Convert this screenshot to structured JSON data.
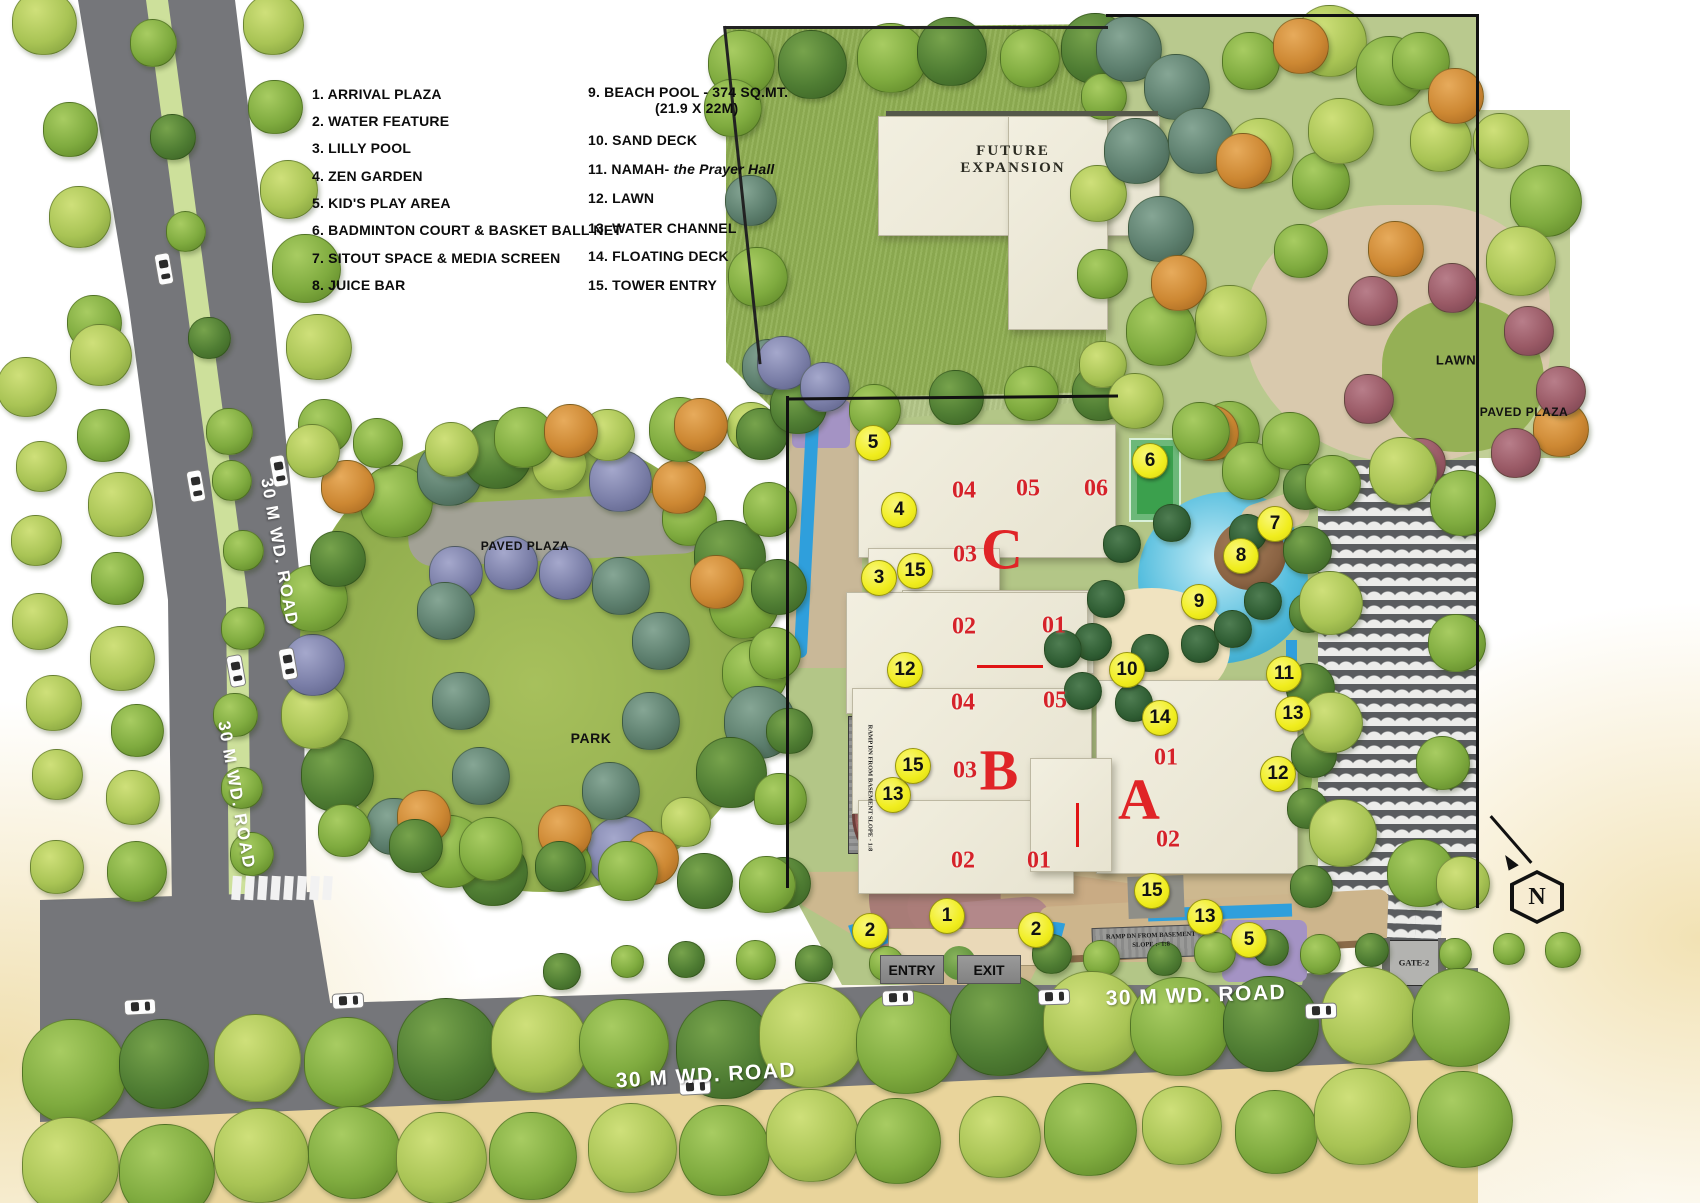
{
  "legend": {
    "left": [
      "1. ARRIVAL PLAZA",
      "2. WATER FEATURE",
      "3. LILLY POOL",
      "4. ZEN GARDEN",
      "5. KID'S PLAY AREA",
      "6. BADMINTON COURT & BASKET BALL NET",
      "7. SITOUT SPACE & MEDIA SCREEN",
      "8. JUICE BAR"
    ],
    "right": [
      {
        "text": "9. BEACH POOL - 374 SQ.MT."
      },
      {
        "text": "(21.9 X 22M)",
        "indent": true
      },
      {
        "text": "10. SAND DECK"
      },
      {
        "text": "11. NAMAH-",
        "italic": " the Prayer Hall"
      },
      {
        "text": "12. LAWN"
      },
      {
        "text": "13. WATER CHANNEL"
      },
      {
        "text": "14. FLOATING DECK"
      },
      {
        "text": "15. TOWER ENTRY"
      }
    ]
  },
  "area_labels": [
    {
      "id": "future-expansion",
      "lines": [
        "FUTURE",
        "EXPANSION"
      ],
      "x": 1013,
      "y": 160,
      "kind": "serif-zone",
      "size": 15
    },
    {
      "id": "lawn-ne",
      "text": "LAWN",
      "x": 1456,
      "y": 360,
      "kind": "zone",
      "size": 13
    },
    {
      "id": "paved-plaza-ne",
      "text": "PAVED PLAZA",
      "x": 1524,
      "y": 412,
      "kind": "zone",
      "size": 12
    },
    {
      "id": "paved-plaza-w",
      "text": "PAVED PLAZA",
      "x": 525,
      "y": 546,
      "kind": "zone",
      "size": 12
    },
    {
      "id": "park",
      "text": "PARK",
      "x": 591,
      "y": 738,
      "kind": "zone",
      "size": 14
    }
  ],
  "gates": {
    "entry_label": "ENTRY",
    "exit_label": "EXIT",
    "gate2_label": "GATE-2",
    "ramp_plaque_lines": [
      "RAMP DN FROM BASEMENT",
      "SLOPE :- 1:8"
    ],
    "ramp_left_text": "RAMP DN FROM BASEMENT   SLOPE - 1:8"
  },
  "road_labels": [
    {
      "text": "30 M WD. ROAD",
      "x": 279,
      "y": 552,
      "rot": 80,
      "size": 17
    },
    {
      "text": "30 M WD. ROAD",
      "x": 236,
      "y": 795,
      "rot": 80,
      "size": 17
    },
    {
      "text": "30 M WD. ROAD",
      "x": 706,
      "y": 1076,
      "rot": -3.5,
      "size": 21
    },
    {
      "text": "30 M WD. ROAD",
      "x": 1196,
      "y": 996,
      "rot": -2,
      "size": 21
    }
  ],
  "markers": [
    {
      "n": "1",
      "x": 947,
      "y": 916
    },
    {
      "n": "2",
      "x": 870,
      "y": 931
    },
    {
      "n": "2",
      "x": 1036,
      "y": 930
    },
    {
      "n": "3",
      "x": 879,
      "y": 578
    },
    {
      "n": "4",
      "x": 899,
      "y": 510
    },
    {
      "n": "5",
      "x": 873,
      "y": 443
    },
    {
      "n": "5",
      "x": 1249,
      "y": 940
    },
    {
      "n": "6",
      "x": 1150,
      "y": 461
    },
    {
      "n": "7",
      "x": 1275,
      "y": 524
    },
    {
      "n": "8",
      "x": 1241,
      "y": 556
    },
    {
      "n": "9",
      "x": 1199,
      "y": 602
    },
    {
      "n": "10",
      "x": 1127,
      "y": 670
    },
    {
      "n": "11",
      "x": 1284,
      "y": 674
    },
    {
      "n": "12",
      "x": 905,
      "y": 670
    },
    {
      "n": "12",
      "x": 1278,
      "y": 774
    },
    {
      "n": "13",
      "x": 1293,
      "y": 714
    },
    {
      "n": "13",
      "x": 893,
      "y": 795
    },
    {
      "n": "13",
      "x": 1205,
      "y": 917
    },
    {
      "n": "14",
      "x": 1160,
      "y": 718
    },
    {
      "n": "15",
      "x": 915,
      "y": 571
    },
    {
      "n": "15",
      "x": 913,
      "y": 766
    },
    {
      "n": "15",
      "x": 1152,
      "y": 891
    }
  ],
  "buildings": {
    "towers": [
      {
        "letter": "C",
        "x": 1002,
        "y": 549
      },
      {
        "letter": "B",
        "x": 999,
        "y": 770
      },
      {
        "letter": "A",
        "x": 1139,
        "y": 799
      }
    ],
    "units": [
      {
        "t": "04",
        "x": 964,
        "y": 491
      },
      {
        "t": "05",
        "x": 1028,
        "y": 489
      },
      {
        "t": "06",
        "x": 1096,
        "y": 489
      },
      {
        "t": "03",
        "x": 965,
        "y": 555
      },
      {
        "t": "02",
        "x": 964,
        "y": 627
      },
      {
        "t": "01",
        "x": 1054,
        "y": 626
      },
      {
        "t": "04",
        "x": 963,
        "y": 703
      },
      {
        "t": "05",
        "x": 1055,
        "y": 701
      },
      {
        "t": "03",
        "x": 965,
        "y": 771
      },
      {
        "t": "02",
        "x": 963,
        "y": 861
      },
      {
        "t": "01",
        "x": 1039,
        "y": 861
      },
      {
        "t": "01",
        "x": 1166,
        "y": 758
      },
      {
        "t": "02",
        "x": 1168,
        "y": 840
      }
    ]
  },
  "compass": {
    "label": "N"
  },
  "colors": {
    "marker_yellow": "#f0ed1d",
    "unit_red": "#d6222a",
    "tower_red": "#e02427",
    "road_gray": "#75767a",
    "pool_blue": "#56bede",
    "channel_blue": "#2f9fdc",
    "lawn_green": "#8fae52"
  }
}
